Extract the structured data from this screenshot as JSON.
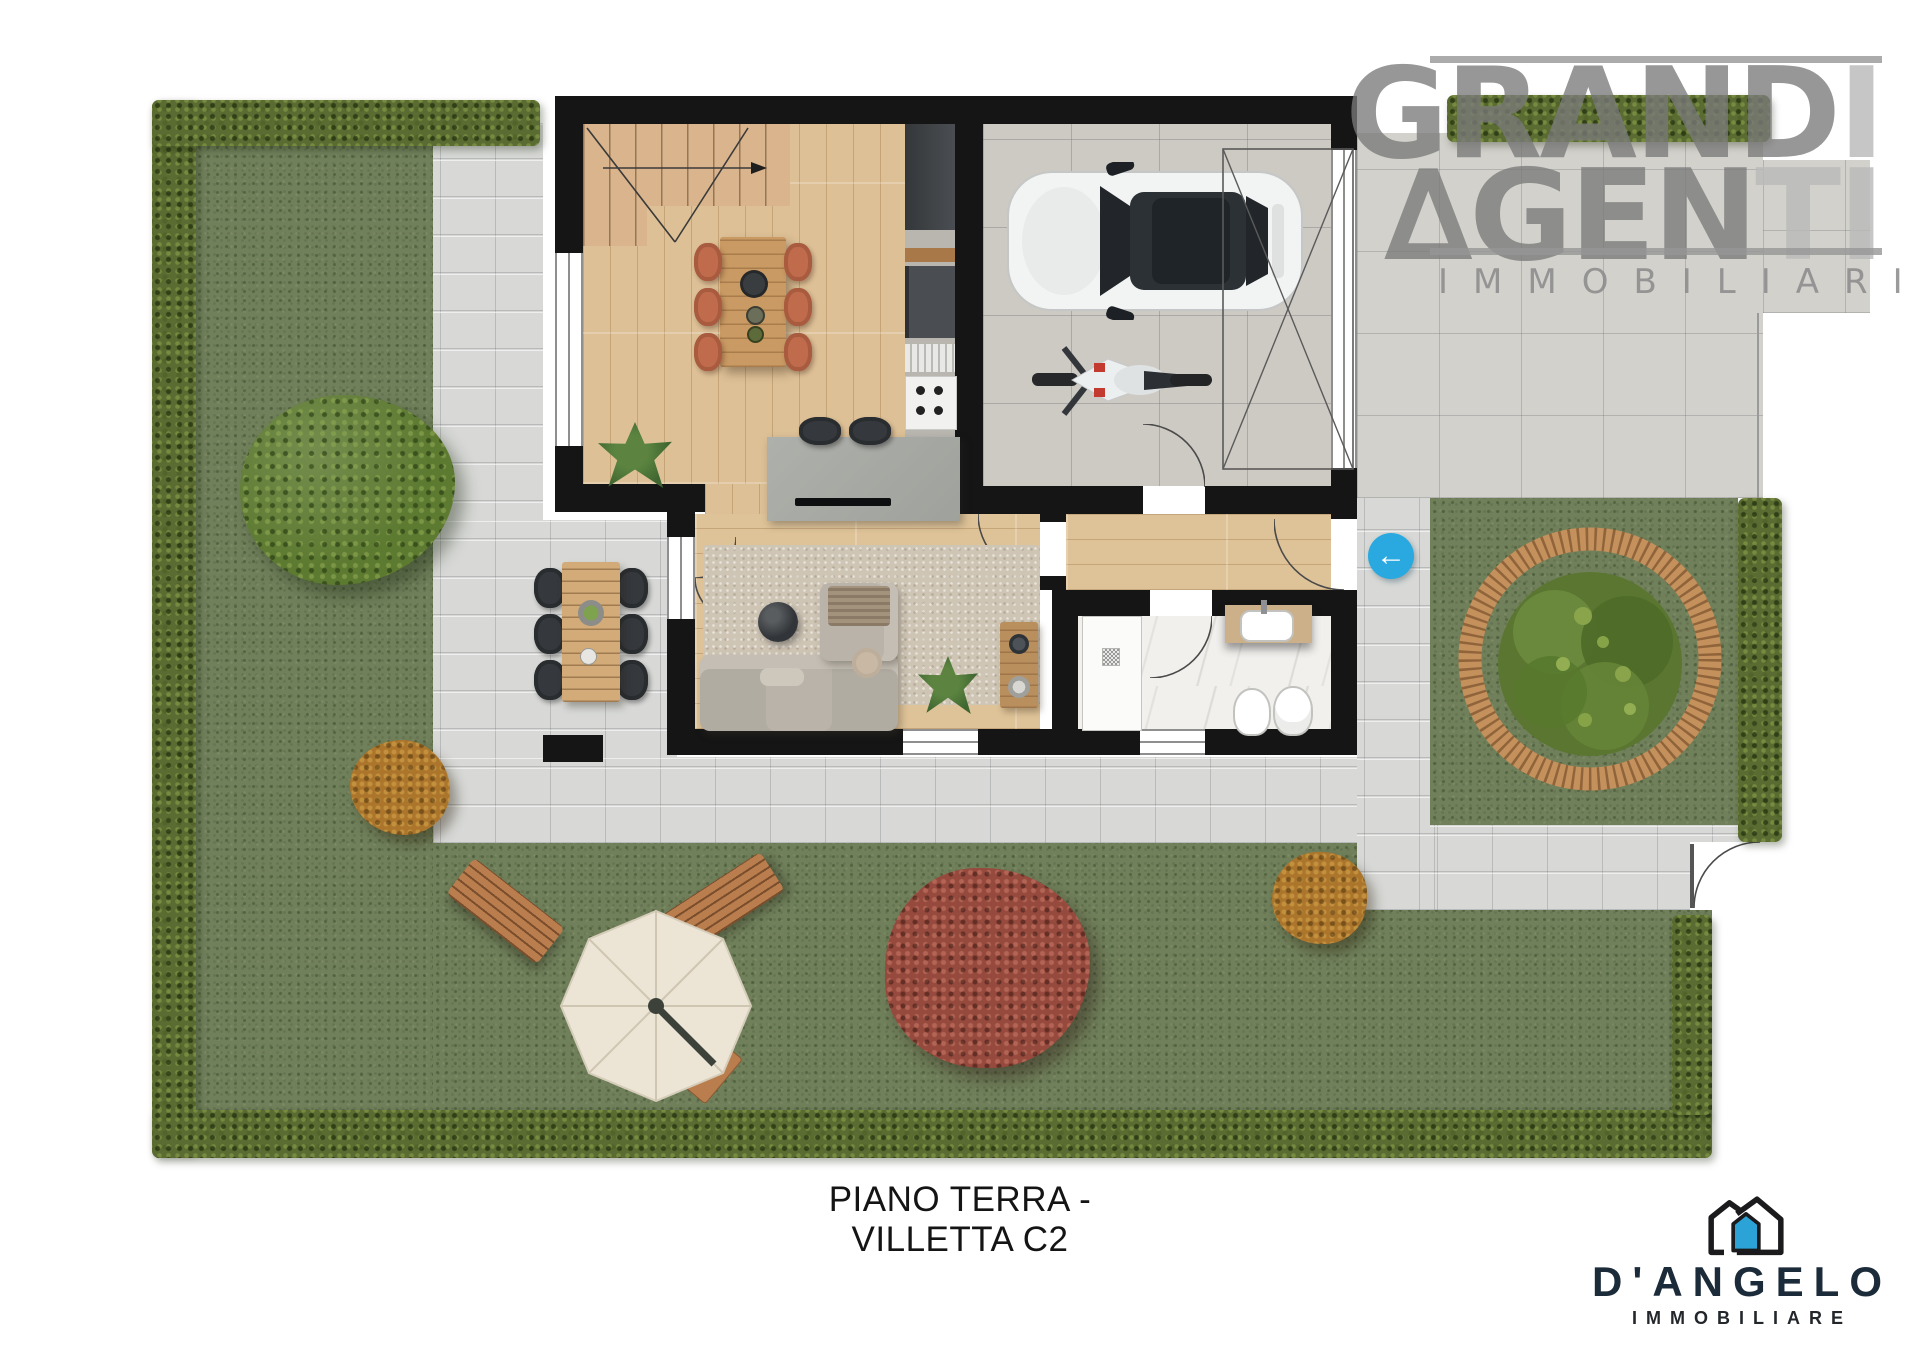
{
  "caption": "PIANO TERRA - VILLETTA C2",
  "watermark_logo": {
    "word1_main": "GRAND",
    "word1_accent": "I",
    "word2_delta": "∆",
    "word2_main": "GEN",
    "word2_accent": "TI",
    "word3": "IMMOBILIARI",
    "main_color": "#7a7a7a",
    "accent_color": "#bababa"
  },
  "agency_logo": {
    "name": "D'ANGELO",
    "subtitle": "IMMOBILIARE",
    "name_color": "#1c2b39",
    "door_blue": "#2ba3d6",
    "outline_color": "#1b1b1e"
  },
  "entrance_marker": {
    "arrow": "←",
    "color": "#29a9e0"
  },
  "palette": {
    "grass": "#70805b",
    "hedge": "#5a6c31",
    "paving": "#d8d9d7",
    "driveway": "#d3d1cc",
    "garage_floor": "#cdc9c3",
    "wood_floor": "#ddc096",
    "marble": "#f2f0ed",
    "wall": "#151515",
    "stairs": "#d9b48c",
    "dining_chairs": "#bf6b4c",
    "outdoor_chairs": "#35383c",
    "sofa": "#b9b3a9",
    "rug": "#cfc5b5",
    "bench_wood": "#c4905c",
    "tree_green": "#5d7a31",
    "tree_red": "#964a3d",
    "bush_orange": "#ab752c",
    "parasol": "#ece4d4",
    "car": "#f2f3f3",
    "motorcycle": "#eceff0"
  }
}
